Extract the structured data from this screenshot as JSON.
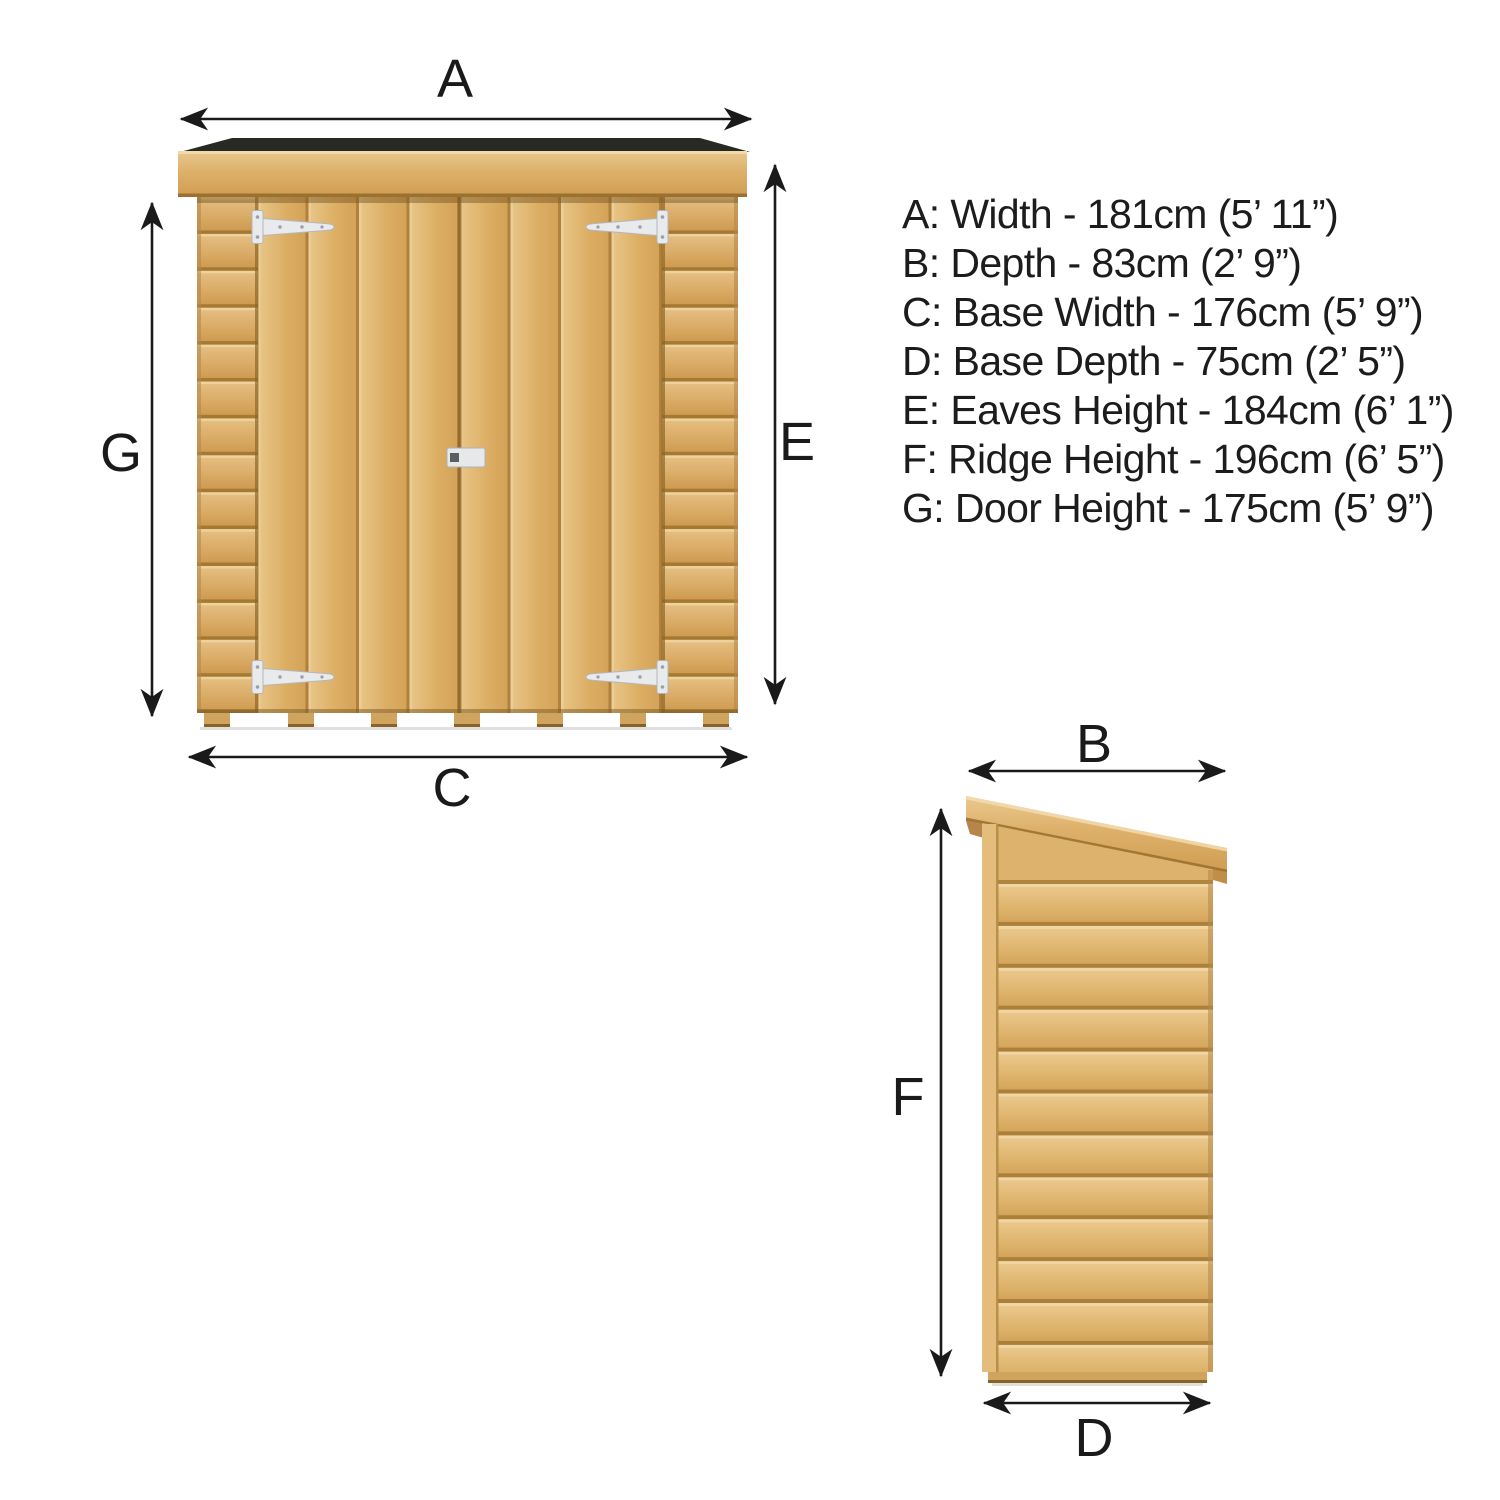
{
  "dimension_list": {
    "lines": [
      "A: Width - 181cm (5’ 11”)",
      "B: Depth - 83cm (2’ 9”)",
      "C: Base Width - 176cm (5’ 9”)",
      "D: Base Depth - 75cm (2’ 5”)",
      "E: Eaves Height - 184cm (6’ 1”)",
      "F: Ridge Height - 196cm (6’ 5”)",
      "G: Door Height - 175cm (5’ 9”)"
    ]
  },
  "labels": {
    "a": "A",
    "b": "B",
    "c": "C",
    "d": "D",
    "e": "E",
    "f": "F",
    "g": "G"
  },
  "colors": {
    "background": "#ffffff",
    "arrow": "#1a1a1a",
    "text": "#1c1c1c",
    "roof_felt": "#262a22",
    "wood_highlight": "#f0d7a4",
    "wood_light": "#e8c689",
    "wood_mid": "#d8a75e",
    "wood_dark": "#a2762f",
    "hinge_metal": "#e9eaec"
  }
}
